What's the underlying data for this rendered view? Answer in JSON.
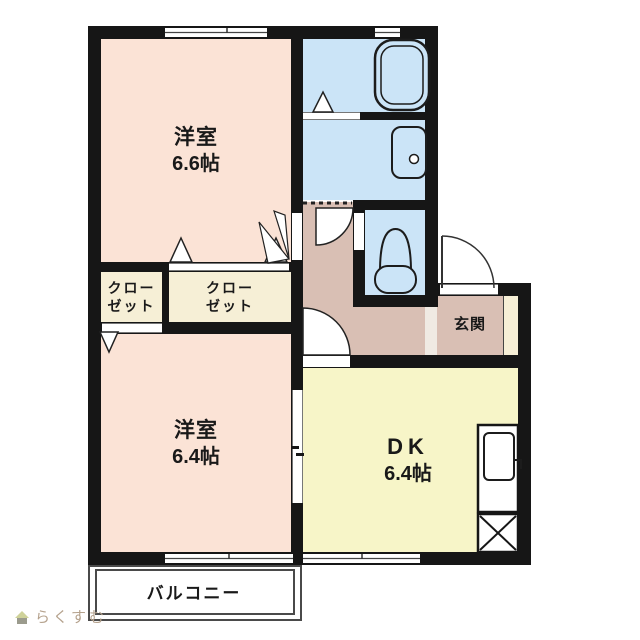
{
  "theme": {
    "wall": "#161616",
    "room-peach": "#fbe3d6",
    "closet-cream": "#f6efd6",
    "dk-yellow": "#f7f5c8",
    "water-blue": "#cbe4f7",
    "corridor-mauve": "#d9bfb4",
    "step-light": "#f0eae3",
    "balcony-line": "#4a4a4a",
    "logo-text": "#b5a28d",
    "logo-roof": "#cfd29a",
    "logo-body": "#9b9b8d"
  },
  "rooms": {
    "bedroom1": {
      "name": "洋室",
      "size": "6.6帖"
    },
    "bedroom2": {
      "name": "洋室",
      "size": "6.4帖"
    },
    "dining_kitchen": {
      "name": "DK",
      "size": "6.4帖"
    },
    "closet_left": {
      "line1": "クロー",
      "line2": "ゼット"
    },
    "closet_right": {
      "line1": "クロー",
      "line2": "ゼット"
    },
    "entrance": {
      "name": "玄関"
    },
    "balcony": {
      "name": "バルコニー"
    }
  },
  "fixtures": [
    "bathtub",
    "wash-basin",
    "toilet",
    "kitchen-sink",
    "refrigerator-space",
    "entrance-door",
    "hinged-door",
    "folding-door",
    "sliding-door",
    "window"
  ],
  "logo": {
    "text": "らくすむ"
  }
}
